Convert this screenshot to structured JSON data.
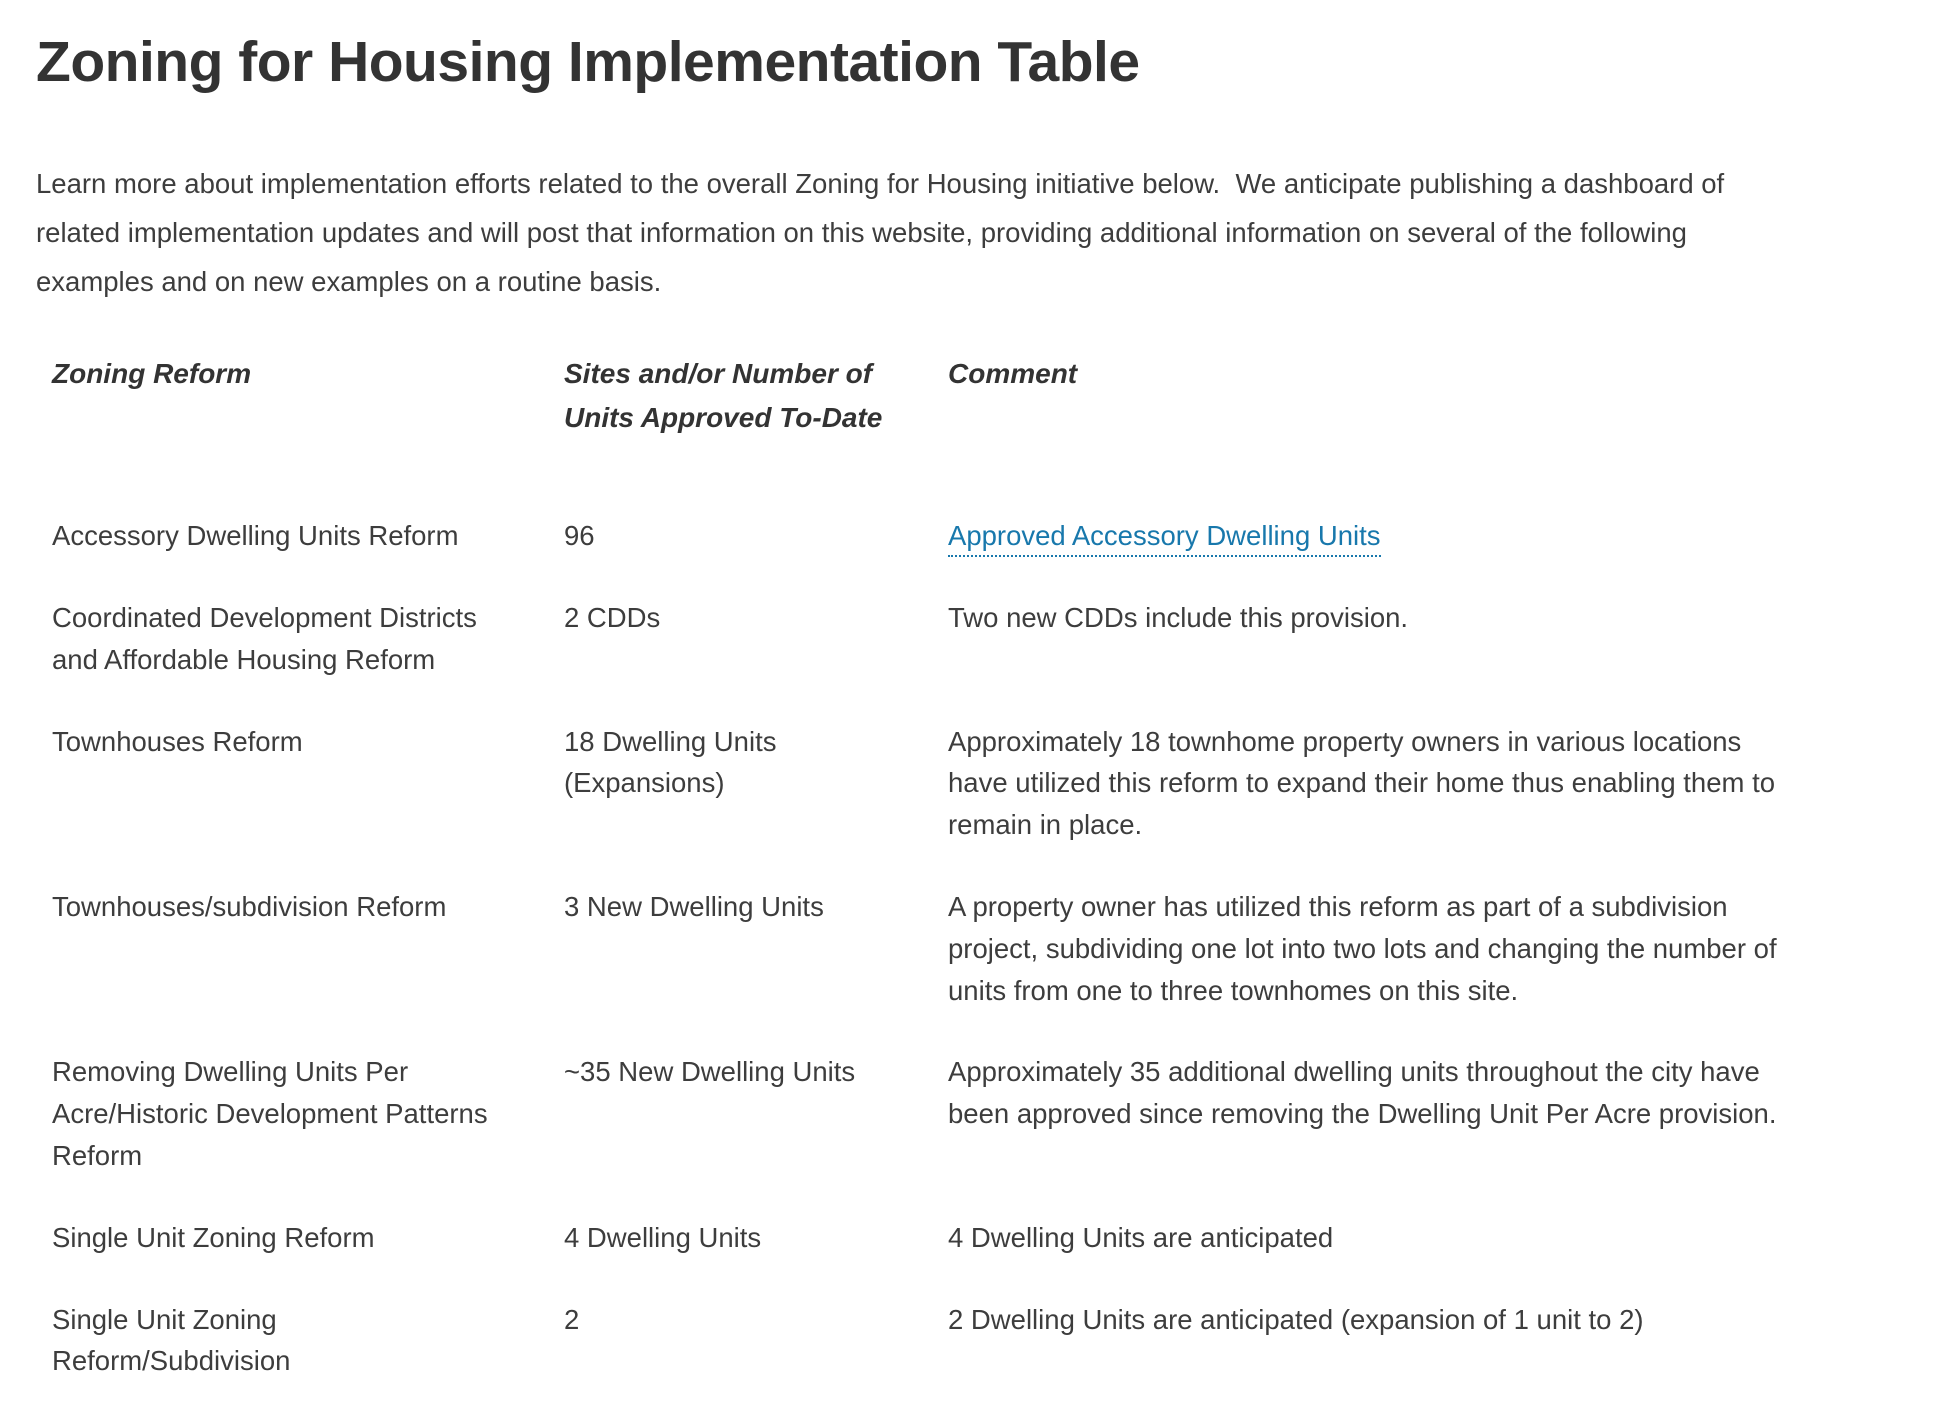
{
  "page": {
    "title": "Zoning for Housing Implementation Table",
    "intro": "Learn more about implementation efforts related to the overall Zoning for Housing initiative below.  We anticipate publishing a dashboard of related implementation updates and will post that information on this website, providing additional information on several of the following examples and on new examples on a routine basis."
  },
  "colors": {
    "link_blue": "#1878ac",
    "body_text": "#3d3d3d",
    "heading_text": "#333333"
  },
  "table": {
    "headers": [
      "Zoning Reform",
      "Sites and/or Number of Units Approved To-Date",
      "Comment"
    ],
    "rows": [
      {
        "reform": "Accessory Dwelling Units Reform",
        "sites": "96",
        "comment_link": "Approved Accessory Dwelling Units"
      },
      {
        "reform": "Coordinated Development Districts and Affordable Housing Reform",
        "sites": "2 CDDs",
        "comment": "Two new CDDs include this provision."
      },
      {
        "reform": "Townhouses Reform",
        "sites": "18 Dwelling Units (Expansions)",
        "comment": "Approximately 18 townhome property owners in various locations have utilized this reform to expand their home thus enabling them to remain in place."
      },
      {
        "reform": "Townhouses/subdivision Reform",
        "sites": "3 New Dwelling Units",
        "comment": "A property owner has utilized this reform as part of a subdivision project, subdividing one lot into two lots and changing the number of units from one to three townhomes on this site."
      },
      {
        "reform": "Removing Dwelling Units Per Acre/Historic Development Patterns Reform",
        "sites": "~35 New Dwelling Units",
        "comment": "Approximately 35 additional dwelling units throughout the city have been approved since removing the Dwelling Unit Per Acre provision."
      },
      {
        "reform": "Single Unit Zoning Reform",
        "sites": "4 Dwelling Units",
        "comment": "4 Dwelling Units are anticipated"
      },
      {
        "reform": "Single Unit Zoning Reform/Subdivision",
        "sites": "2",
        "comment": "2 Dwelling Units are anticipated (expansion of 1 unit to 2)"
      }
    ]
  }
}
